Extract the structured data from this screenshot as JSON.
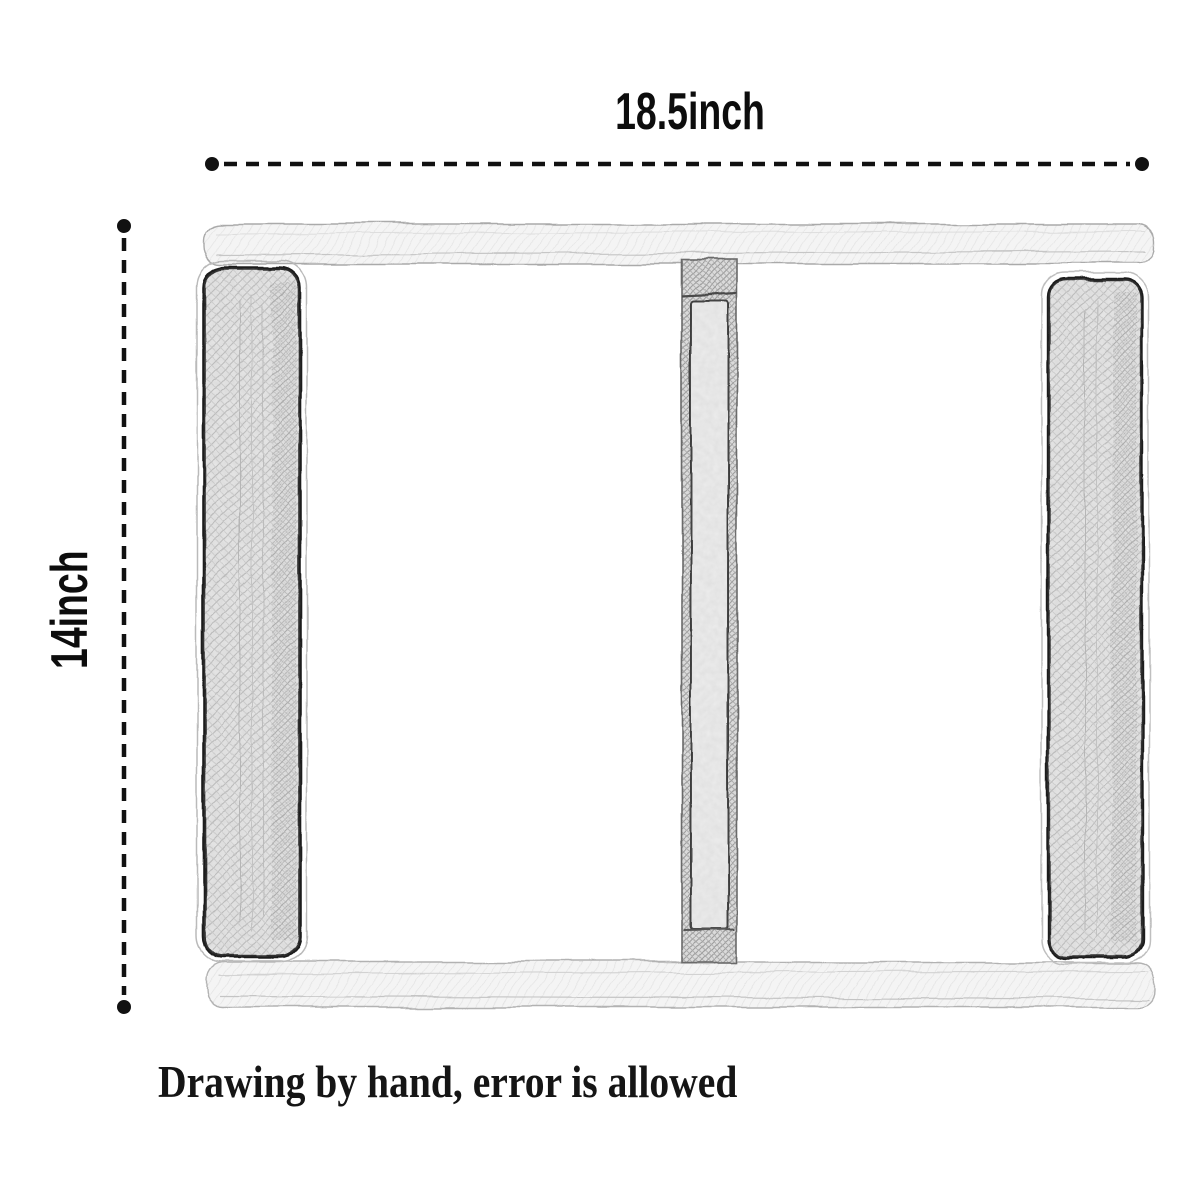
{
  "labels": {
    "width": "18.5inch",
    "height": "14inch",
    "note": "Drawing by hand, error is allowed"
  },
  "colors": {
    "background": "#ffffff",
    "ink": "#111111",
    "panel_outline": "#1e1e1e",
    "panel_fill": "#e7e7e7",
    "rail_fill": "#f4f4f4",
    "divider_hatch": "#dadada"
  }
}
